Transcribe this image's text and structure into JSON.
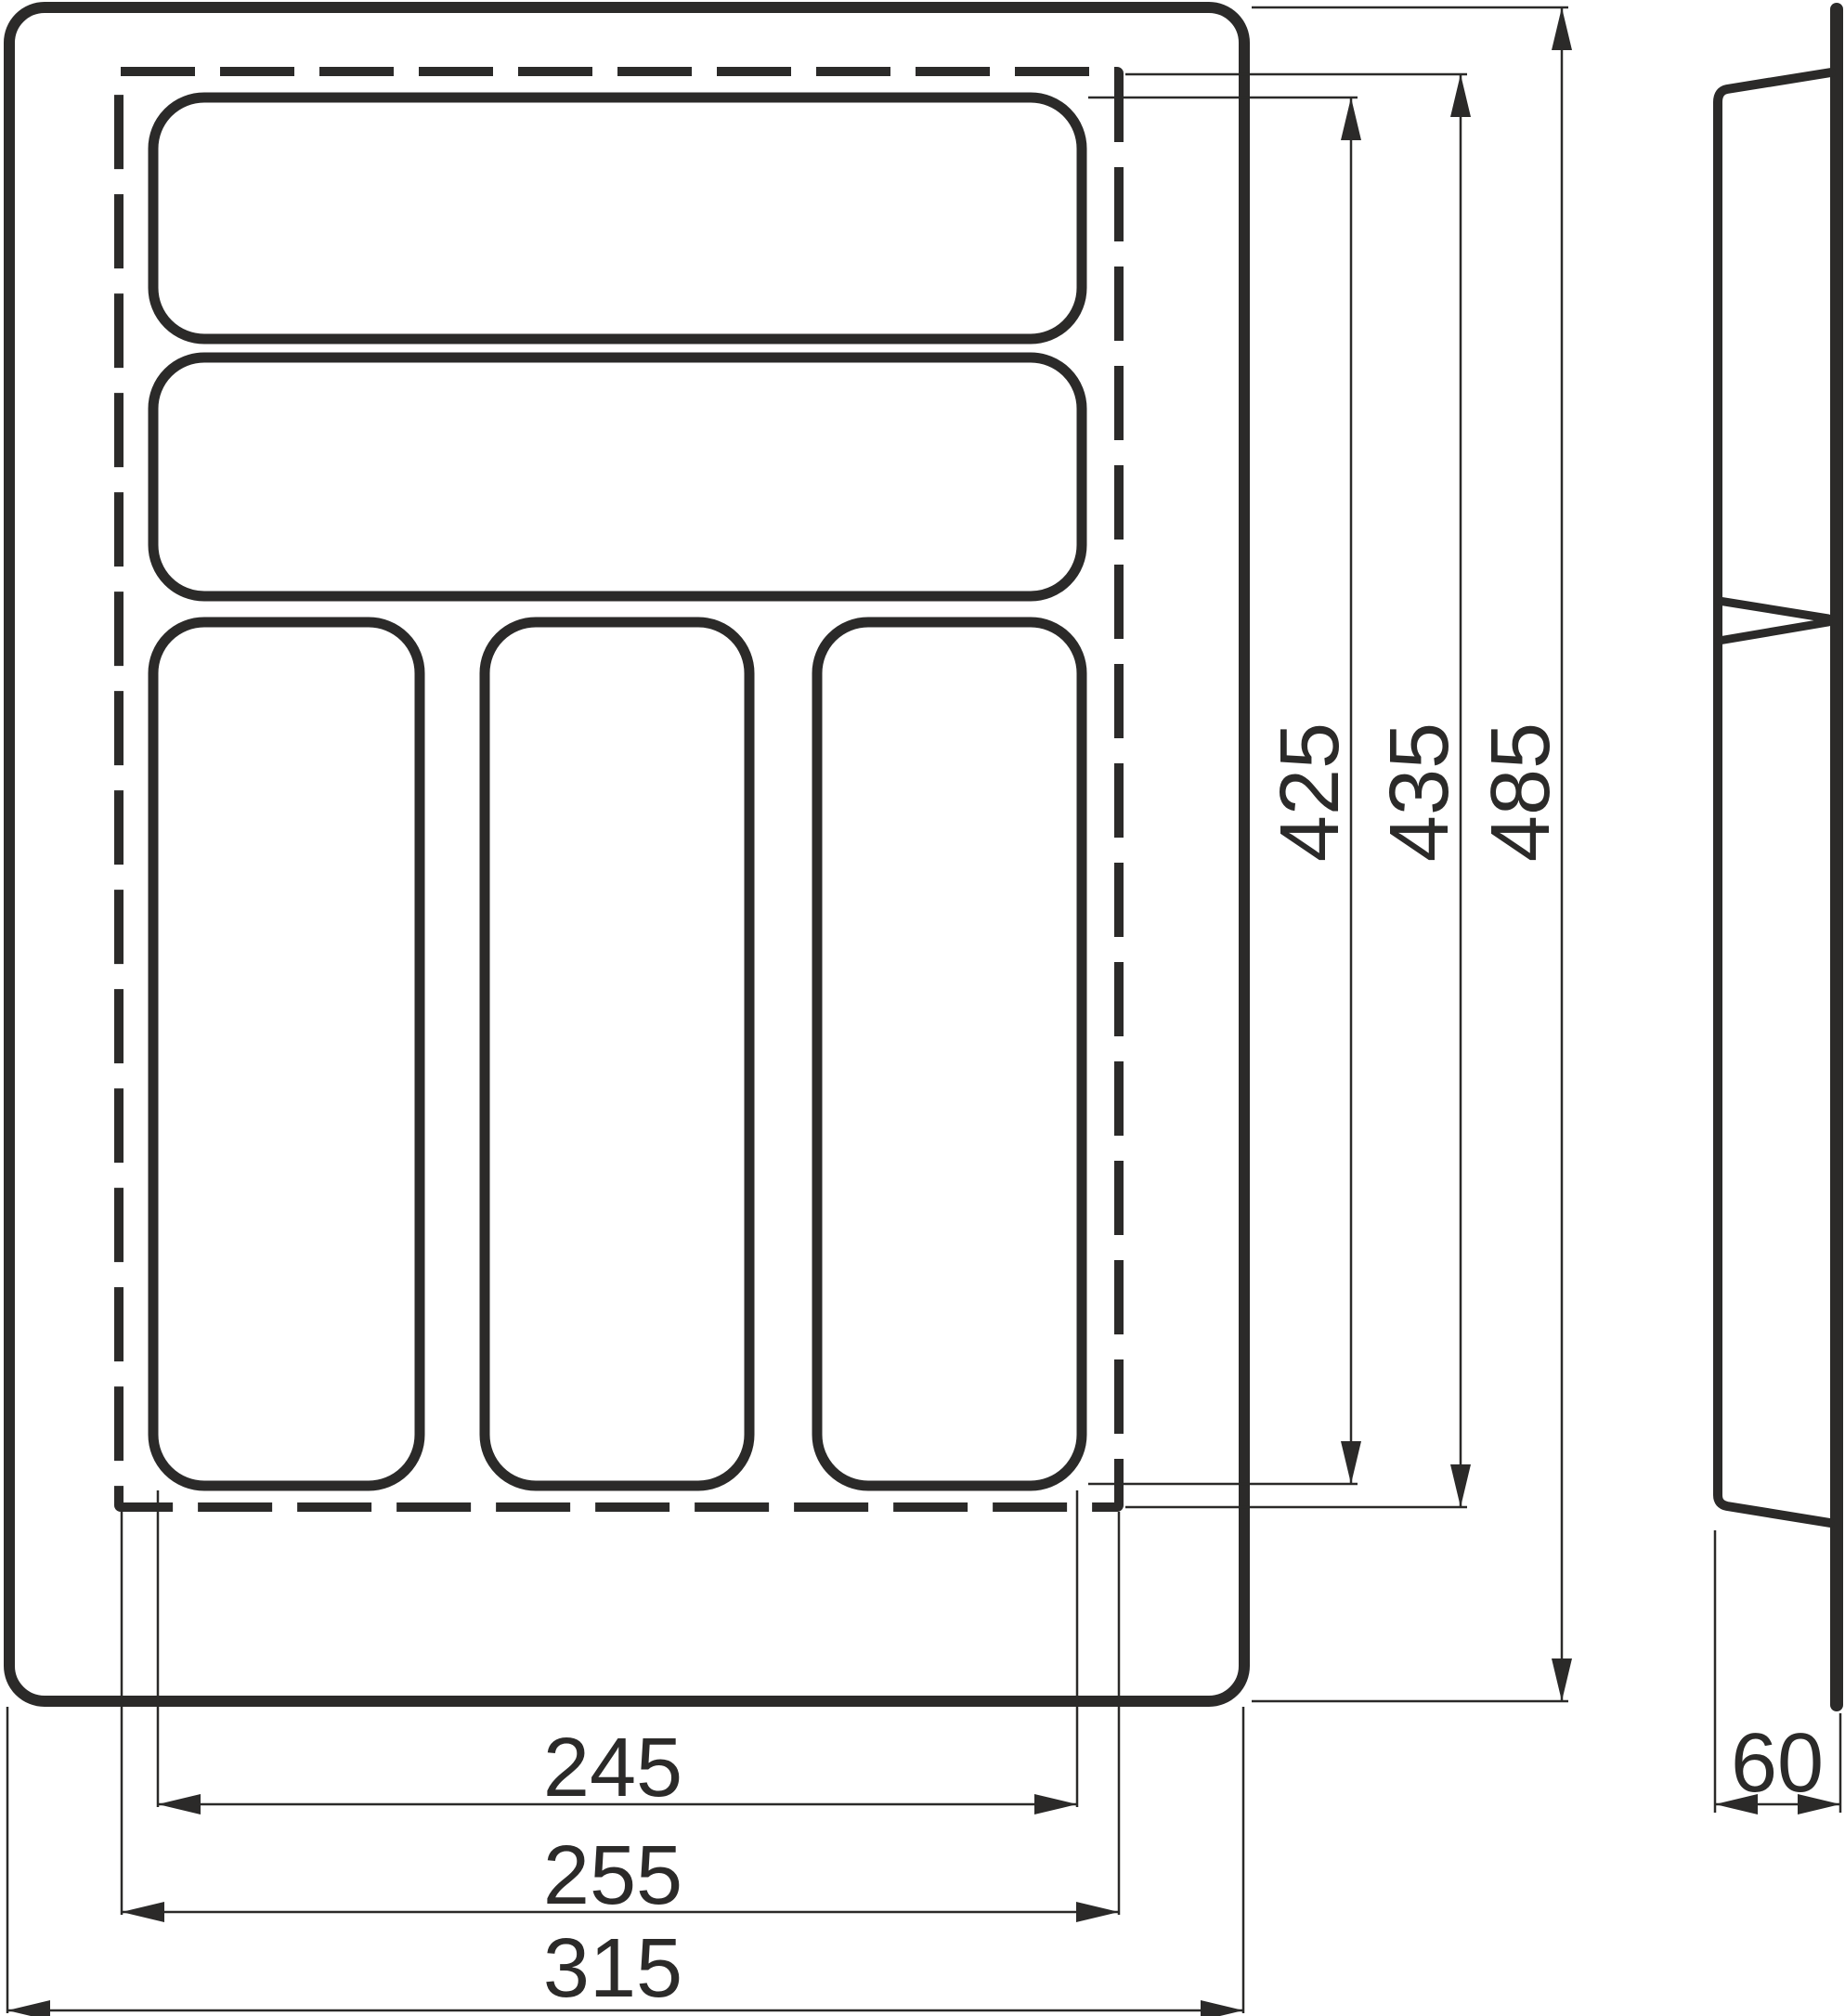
{
  "title": "Cutlery tray insert dimension drawing",
  "colors": {
    "line": "#2b2a29",
    "background": "#ffffff"
  },
  "views": {
    "front": {
      "outer_outline": "tray outer edge",
      "cutting_line": "dashed trimming line",
      "compartments": [
        "top wide compartment",
        "second wide compartment",
        "left vertical compartment",
        "middle vertical compartment",
        "right vertical compartment"
      ]
    },
    "side": {
      "profile": "tray side section"
    }
  },
  "dims": {
    "v425": {
      "value": "425",
      "unit": "mm",
      "orientation": "vertical"
    },
    "v435": {
      "value": "435",
      "unit": "mm",
      "orientation": "vertical"
    },
    "v485": {
      "value": "485",
      "unit": "mm",
      "orientation": "vertical"
    },
    "h245": {
      "value": "245",
      "unit": "mm",
      "orientation": "horizontal"
    },
    "h255": {
      "value": "255",
      "unit": "mm",
      "orientation": "horizontal"
    },
    "h315": {
      "value": "315",
      "unit": "mm",
      "orientation": "horizontal"
    },
    "s60": {
      "value": "60",
      "unit": "mm",
      "orientation": "horizontal"
    }
  }
}
